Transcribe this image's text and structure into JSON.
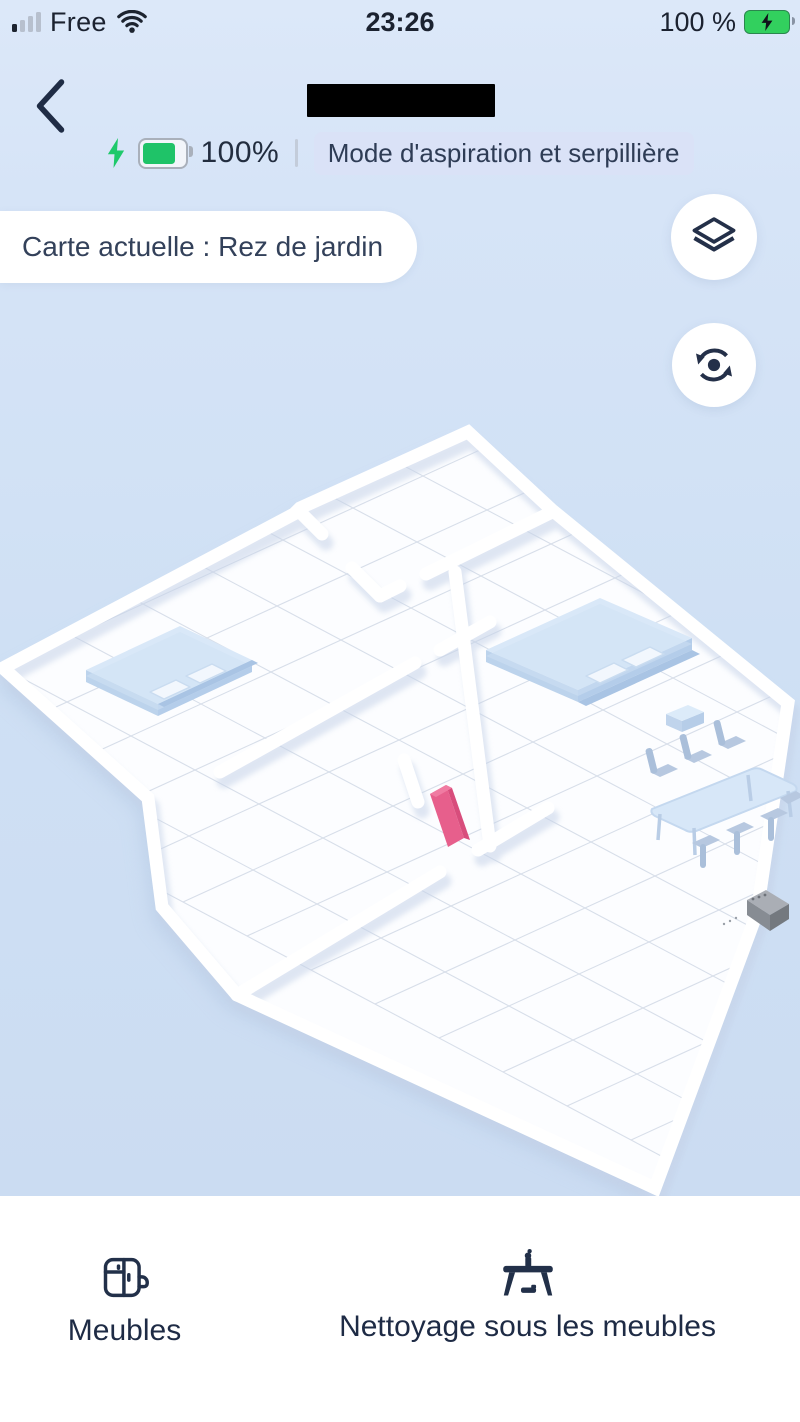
{
  "status_bar": {
    "carrier": "Free",
    "time": "23:26",
    "battery": "100 %"
  },
  "header": {
    "battery_level": "100%",
    "mode_badge": "Mode d'aspiration et serpillière"
  },
  "map_bar": {
    "current_map": "Carte actuelle : Rez de jardin"
  },
  "map": {
    "type": "3d-floor-plan",
    "rooms": [
      "left-bedroom",
      "top-room",
      "right-living-room",
      "corridor",
      "bottom-room"
    ],
    "objects": [
      "bed-1",
      "bed-2",
      "nightstand",
      "dining-table",
      "chairs",
      "charging-dock",
      "door-marker"
    ],
    "accent_colors": {
      "door_marker": "#e75f8c",
      "furniture_blue": "#d3e4f6",
      "dock_gray": "#8e939a"
    }
  },
  "bottom_bar": {
    "items": [
      {
        "label": "Meubles",
        "icon": "furniture-icon"
      },
      {
        "label": "Nettoyage sous les meubles",
        "icon": "clean-under-furniture-icon"
      }
    ]
  },
  "icons": {
    "back": "chevron-left",
    "wifi": "wifi",
    "status_battery": "battery-charging",
    "charging_bolt": "lightning-bolt",
    "map_layers": "layers",
    "map_reset": "rotate-reset"
  }
}
